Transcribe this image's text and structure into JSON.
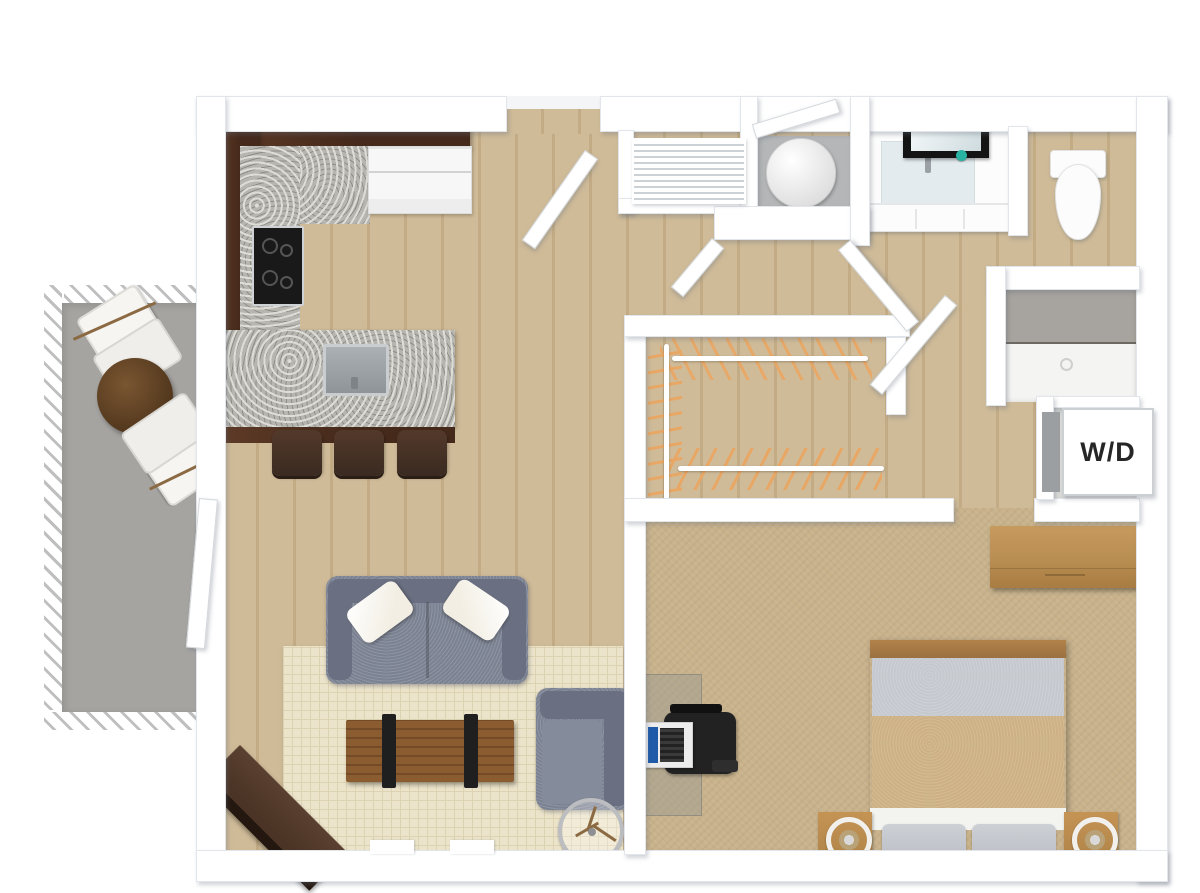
{
  "labels": {
    "washer_dryer": "W/D"
  },
  "scene": {
    "view": "top-down 3d floor plan render",
    "rooms": [
      {
        "id": "balcony",
        "furniture": [
          "patio-table",
          "patio-chair",
          "patio-chair"
        ]
      },
      {
        "id": "kitchen",
        "furniture": [
          "upper-cabinets",
          "granite-counter",
          "cooktop",
          "refrigerator",
          "peninsula-counter",
          "kitchen-sink",
          "bar-stool",
          "bar-stool",
          "bar-stool"
        ]
      },
      {
        "id": "living-room",
        "furniture": [
          "sofa",
          "throw-pillow",
          "throw-pillow",
          "coffee-table",
          "armchair",
          "tripod-floor-lamp",
          "tv-console",
          "area-rug"
        ]
      },
      {
        "id": "entry-hall",
        "furniture": [
          "entry-door",
          "louvered-closet"
        ]
      },
      {
        "id": "utility-closet",
        "furniture": [
          "water-heater"
        ]
      },
      {
        "id": "bathroom",
        "furniture": [
          "vanity-sink",
          "mirror",
          "toilet"
        ]
      },
      {
        "id": "shower-room",
        "furniture": [
          "glass-shower"
        ]
      },
      {
        "id": "laundry-closet",
        "furniture": [
          "washer-dryer-unit"
        ]
      },
      {
        "id": "walk-in-closet",
        "furniture": [
          "clothes-rod",
          "clothes-rod",
          "clothes-rod",
          "hangers"
        ]
      },
      {
        "id": "bedroom",
        "furniture": [
          "bed",
          "nightstand",
          "nightstand",
          "table-lamp",
          "table-lamp",
          "dresser",
          "desk",
          "office-chair",
          "laptop"
        ]
      }
    ]
  },
  "colors": {
    "wall": "#ffffff",
    "wallEdge": "#e2e6ea",
    "woodFloor": "#cfbb98",
    "woodFloorDark": "#c3ac85",
    "carpet": "#c8b28b",
    "balconyFloor": "#a5a4a1",
    "railing": "#bfbfbf",
    "cabinet": "#45291b",
    "cabinetLight": "#5d3a26",
    "granite": "#b7b5af",
    "graniteDark": "#8f8d88",
    "stove": "#191919",
    "steel": "#9aa0a5",
    "stool": "#3a2a21",
    "fridge": "#f7f7f7",
    "sofa": "#7b8292",
    "sofaDark": "#6a7081",
    "pillow": "#f2eee3",
    "rug": "#ece4ca",
    "rugLine": "#ddd2b2",
    "tableWood": "#8a5c30",
    "tableWoodDark": "#744b26",
    "strap": "#1f1f1f",
    "console": "#4b3425",
    "consoleDark": "#241710",
    "lampMetal": "#bcbdc0",
    "legWood": "#8b6a43",
    "duvet": "#cdb083",
    "blanket": "#c5c9cf",
    "bedPillow": "#bdc1c7",
    "sheet": "#f3f3f0",
    "bedWood": "#9b7141",
    "nightstand": "#b08448",
    "dresser": "#b98e52",
    "dresserDark": "#a87c42",
    "chairBlack": "#222222",
    "laptopBody": "#ececec",
    "screenBlue": "#1e5aa8",
    "porcelain": "#fcfcfc",
    "mirror": "#141414",
    "mirrorGlass": "#e3ebee",
    "teal": "#29b3a2",
    "showerFloor": "#f4f4f3",
    "hanger": "#e8a765",
    "heater": "#f2f2f2",
    "applianceGray": "#9b9fa2",
    "utilityFloor": "#b4b6b7",
    "wdFloor": "#dadad8",
    "louverLine": "#ccd1d5"
  }
}
